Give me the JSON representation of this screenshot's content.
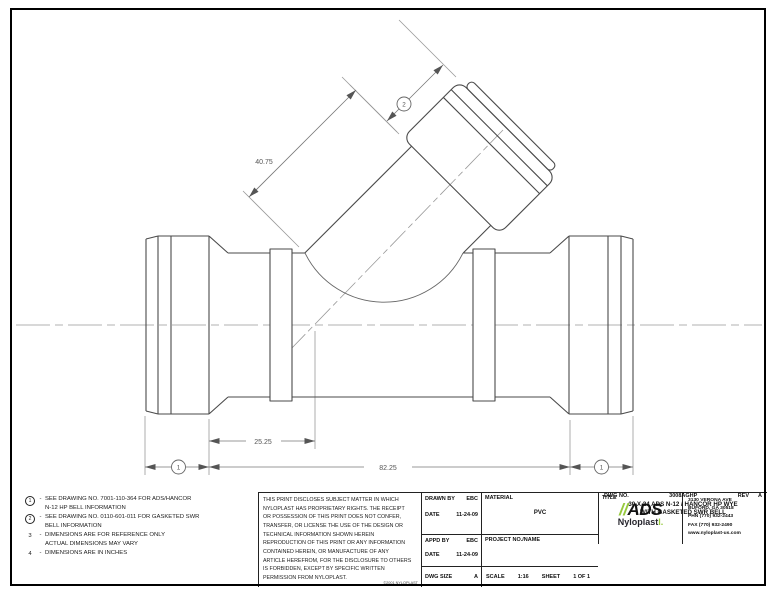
{
  "dims": {
    "branch_length": "40.75",
    "bell_to_center": "25.25",
    "laying_length": "82.25",
    "bell_callout": "1",
    "branch_bell_callout": "2"
  },
  "notes": {
    "separator": "-",
    "items": [
      {
        "marker": "1",
        "line1": "SEE DRAWING NO. 7001-110-364 FOR ADS/HANCOR",
        "line2": "N-12 HP BELL INFORMATION"
      },
      {
        "marker": "2",
        "line1": "SEE DRAWING NO. 0110-601-011 FOR GASKETED SWR",
        "line2": "BELL INFORMATION"
      },
      {
        "marker": "3",
        "line1": "DIMENSIONS ARE FOR REFERENCE ONLY",
        "line2": "ACTUAL DIMENSIONS MAY VARY"
      },
      {
        "marker": "4",
        "line1": "DIMENSIONS ARE IN INCHES",
        "line2": ""
      }
    ]
  },
  "legal": {
    "lines": [
      "THIS PRINT DISCLOSES SUBJECT MATTER IN WHICH",
      "NYLOPLAST HAS PROPRIETARY RIGHTS.  THE RECEIPT",
      "OR POSSESSION OF THIS PRINT DOES NOT CONFER,",
      "TRANSFER, OR LICENSE THE USE OF THE DESIGN OR",
      "TECHNICAL INFORMATION SHOWN HEREIN",
      "REPRODUCTION OF THIS PRINT OR ANY INFORMATION",
      "CONTAINED HEREIN, OR MANUFACTURE OF ANY",
      "ARTICLE HEREFROM, FOR THE DISCLOSURE TO OTHERS",
      "IS FORBIDDEN, EXCEPT BY SPECIFIC WRITTEN",
      "PERMISSION FROM NYLOPLAST."
    ],
    "copyright": "©2001 NYLOPLAST"
  },
  "titleblock": {
    "drawn_by_label": "DRAWN BY",
    "drawn_by": "EBC",
    "date_label": "DATE",
    "drawn_date": "11-24-09",
    "appd_by_label": "APPD BY",
    "appd_by": "EBC",
    "appd_date": "11-24-09",
    "dwg_size_label": "DWG SIZE",
    "dwg_size": "A",
    "material_label": "MATERIAL",
    "material": "PVC",
    "project_label": "PROJECT NO./NAME",
    "scale_label": "SCALE",
    "scale": "1:16",
    "sheet_label": "SHEET",
    "sheet": "1 OF 1",
    "title_label": "TITLE",
    "title_line1": "30 X 24 ADS N-12 / HANCOR HP WYE",
    "title_line2": "WITH GASKETED SWR BELL",
    "dwg_no_label": "DWG NO.",
    "dwg_no": "3008AGHP",
    "rev_label": "REV",
    "rev": "A"
  },
  "company": {
    "logo_slashes": "//",
    "logo_name": "ADS",
    "logo_sub": "Nyloplast",
    "logo_mark": "l.",
    "accent_green": "#96c93d",
    "address": [
      "3130 VERONA AVE",
      "BUFORD, GA 30518",
      "PHN (770) 932-2443",
      "FAX (770) 932-2490",
      "www.nyloplast-us.com"
    ]
  }
}
